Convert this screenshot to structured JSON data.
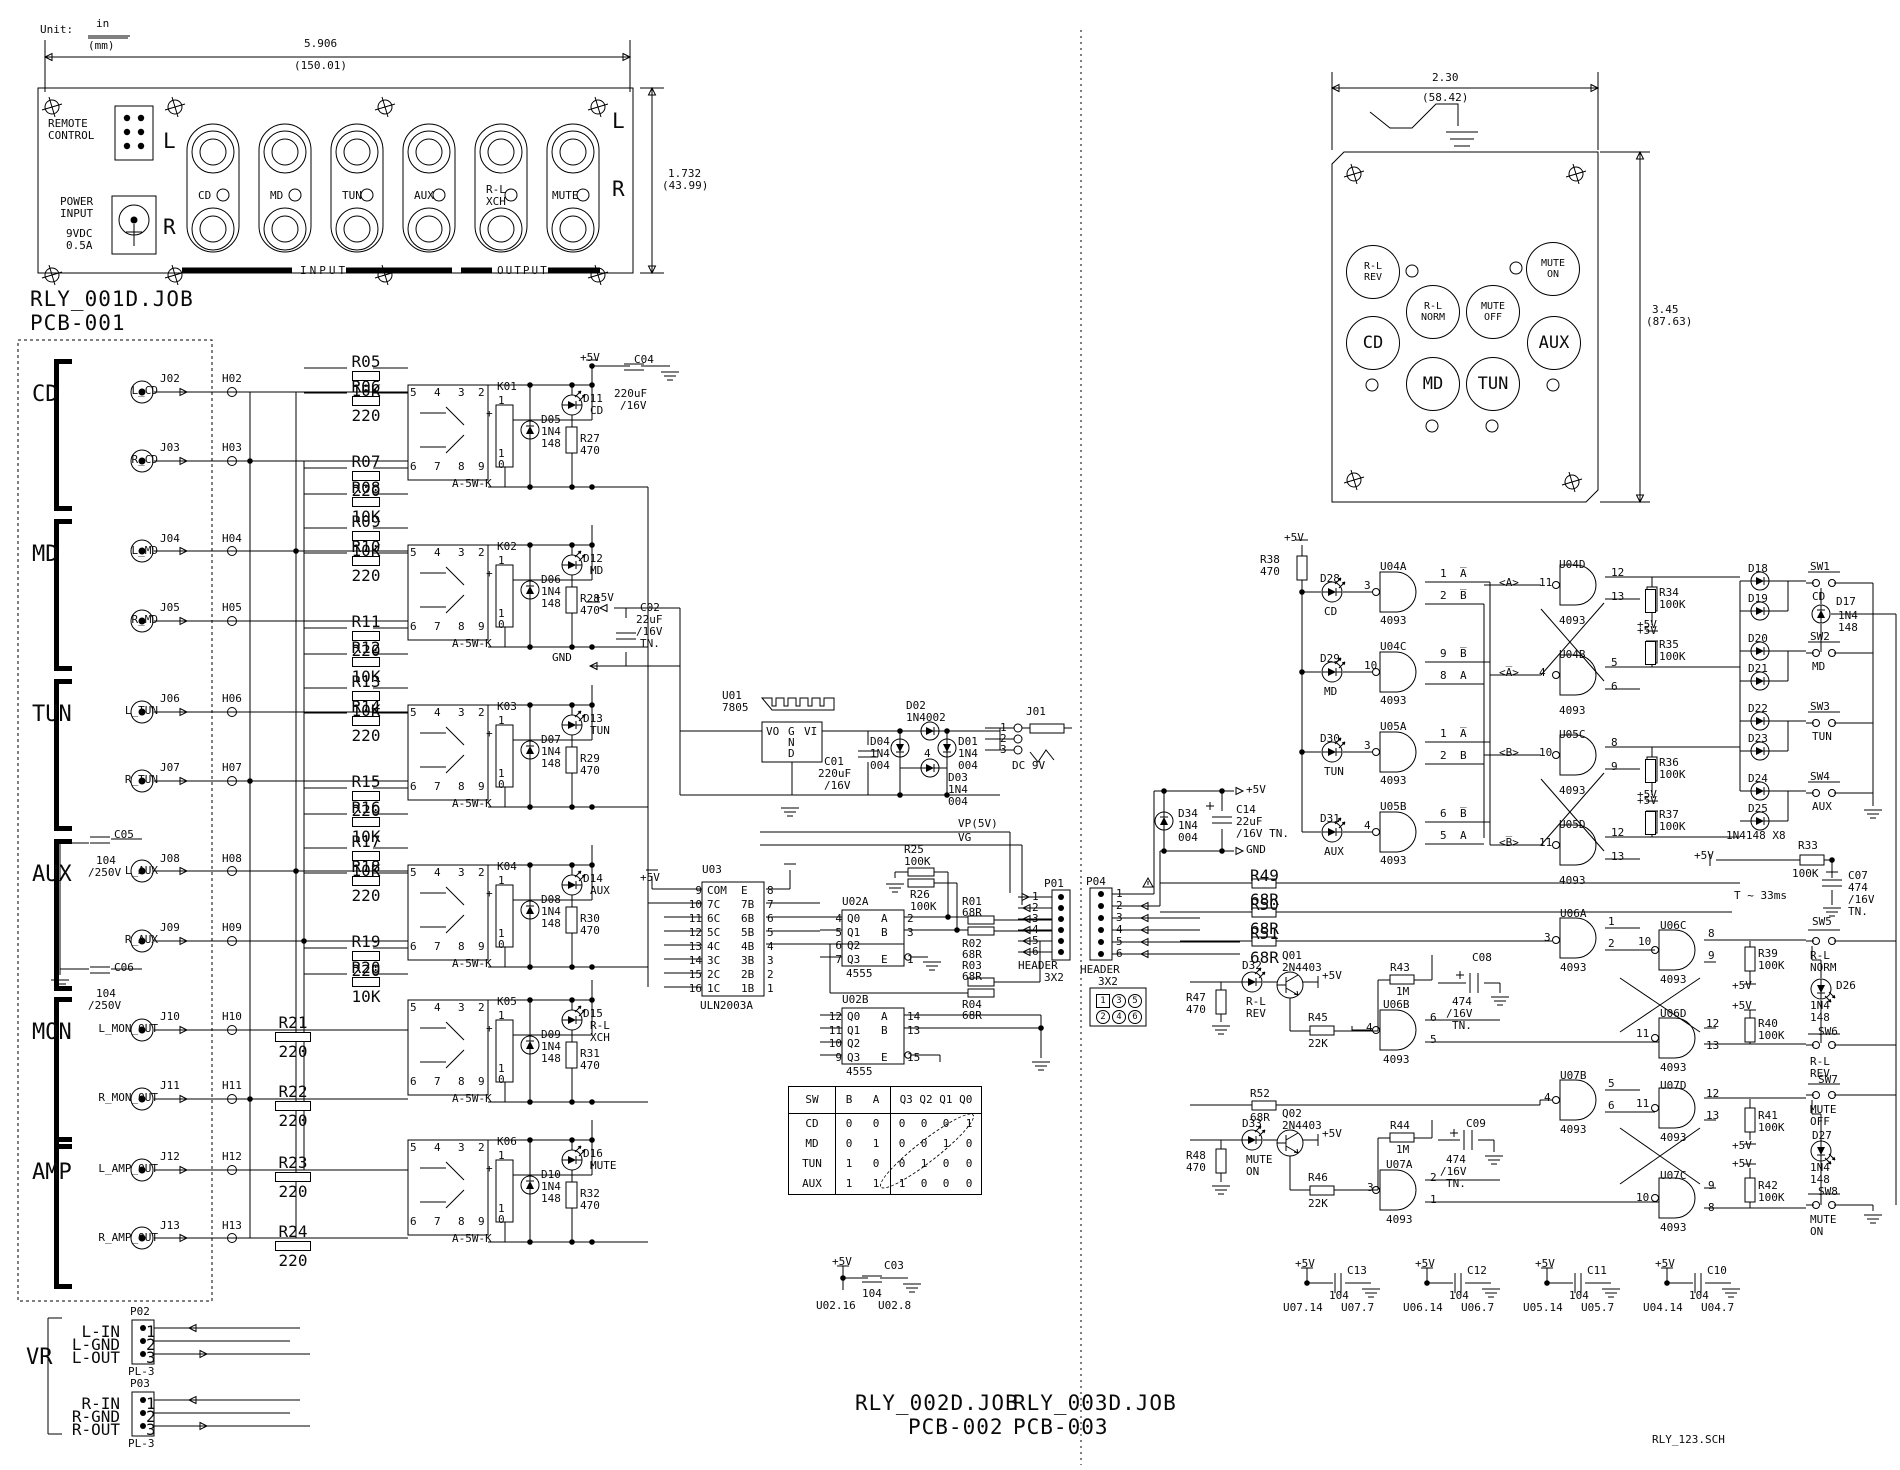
{
  "p5": "+5V",
  "gndl": "GND",
  "unit": {
    "label": "Unit:",
    "num": "in",
    "den": "(mm)"
  },
  "titles": {
    "pcb1_job": "RLY_001D.JOB",
    "pcb1": "PCB-001",
    "pcb2_job": "RLY_002D.JOB",
    "pcb2": "PCB-002",
    "pcb3_job": "RLY_003D.JOB",
    "pcb3": "PCB-003",
    "sch": "RLY_123.SCH"
  },
  "fp": {
    "dw": "5.906",
    "dwm": "(150.01)",
    "dh": "1.732",
    "dhm": "(43.99)",
    "rem1": "REMOTE",
    "rem2": "CONTROL",
    "pow1": "POWER",
    "pow2": "INPUT",
    "pow3": "9VDC",
    "pow4": "0.5A",
    "l": "L",
    "r": "R",
    "input": "INPUT",
    "output": "OUTPUT",
    "jacks": [
      {
        "l1": "CD",
        "l2": ""
      },
      {
        "l1": "MD",
        "l2": ""
      },
      {
        "l1": "TUN",
        "l2": ""
      },
      {
        "l1": "AUX",
        "l2": ""
      },
      {
        "l1": "R-L",
        "l2": "XCH"
      },
      {
        "l1": "MUTE",
        "l2": ""
      }
    ]
  },
  "remote": {
    "dw": "2.30",
    "dwm": "(58.42)",
    "dh": "3.45",
    "dhm": "(87.63)",
    "buttons": [
      {
        "l1": "R-L",
        "l2": "REV"
      },
      {
        "l1": "MUTE",
        "l2": "ON"
      },
      {
        "l1": "R-L",
        "l2": "NORM"
      },
      {
        "l1": "MUTE",
        "l2": "OFF"
      },
      {
        "l1": "CD",
        "l2": ""
      },
      {
        "l1": "AUX",
        "l2": ""
      },
      {
        "l1": "MD",
        "l2": ""
      },
      {
        "l1": "TUN",
        "l2": ""
      }
    ]
  },
  "pcb1": {
    "relay_part": "A-5W-K",
    "rp": {
      "a": "5",
      "b": "4",
      "c": "3",
      "d": "2",
      "e": "6",
      "f": "7",
      "g": "8",
      "h": "9",
      "i": "1",
      "j": "+",
      "k": "1",
      "l": "0"
    },
    "ch1": {
      "p5": "+5V",
      "c": "C04",
      "v1": "220uF",
      "v2": "/16V"
    },
    "groups": [
      {
        "label": "CD",
        "j1": {
          "name": "L_CD",
          "jack": "J02",
          "hdr": "H02",
          "r": "",
          "rv": ""
        },
        "j2": {
          "name": "R_CD",
          "jack": "J03",
          "hdr": "H03",
          "r": "",
          "rv": ""
        },
        "c1": {
          "n": "",
          "v1": "",
          "v2": ""
        },
        "c2": {
          "n": "",
          "v1": "",
          "v2": ""
        }
      },
      {
        "label": "MD",
        "j1": {
          "name": "L_MD",
          "jack": "J04",
          "hdr": "H04",
          "r": "",
          "rv": ""
        },
        "j2": {
          "name": "R_MD",
          "jack": "J05",
          "hdr": "H05",
          "r": "",
          "rv": ""
        },
        "c1": {
          "n": "",
          "v1": "",
          "v2": ""
        },
        "c2": {
          "n": "",
          "v1": "",
          "v2": ""
        }
      },
      {
        "label": "TUN",
        "j1": {
          "name": "L_TUN",
          "jack": "J06",
          "hdr": "H06",
          "r": "",
          "rv": ""
        },
        "j2": {
          "name": "R_TUN",
          "jack": "J07",
          "hdr": "H07",
          "r": "",
          "rv": ""
        },
        "c1": {
          "n": "",
          "v1": "",
          "v2": ""
        },
        "c2": {
          "n": "",
          "v1": "",
          "v2": ""
        }
      },
      {
        "label": "AUX",
        "j1": {
          "name": "L_AUX",
          "jack": "J08",
          "hdr": "H08",
          "r": "",
          "rv": ""
        },
        "j2": {
          "name": "R_AUX",
          "jack": "J09",
          "hdr": "H09",
          "r": "",
          "rv": ""
        },
        "c1": {
          "n": "C05",
          "v1": "104",
          "v2": "/250V"
        },
        "c2": {
          "n": "C06",
          "v1": "104",
          "v2": "/250V"
        }
      },
      {
        "label": "MON",
        "j1": {
          "name": "L_MON_OUT",
          "jack": "J10",
          "hdr": "H10",
          "r": "R21",
          "rv": "220"
        },
        "j2": {
          "name": "R_MON_OUT",
          "jack": "J11",
          "hdr": "H11",
          "r": "R22",
          "rv": "220"
        },
        "c1": {
          "n": "",
          "v1": "",
          "v2": ""
        },
        "c2": {
          "n": "",
          "v1": "",
          "v2": ""
        }
      },
      {
        "label": "AMP",
        "j1": {
          "name": "L_AMP_OUT",
          "jack": "J12",
          "hdr": "H12",
          "r": "R23",
          "rv": "220"
        },
        "j2": {
          "name": "R_AMP_OUT",
          "jack": "J13",
          "hdr": "H13",
          "r": "R24",
          "rv": "220"
        },
        "c1": {
          "n": "",
          "v1": "",
          "v2": ""
        },
        "c2": {
          "n": "",
          "v1": "",
          "v2": ""
        }
      }
    ],
    "channels": [
      {
        "k": "K01",
        "d": "D05",
        "dp1": "1N4",
        "dp2": "148",
        "led": "D11",
        "name": "CD",
        "name2": "",
        "r": "R27",
        "rv": "470",
        "ladder": [
          {
            "n": "R05",
            "v": "10K"
          },
          {
            "n": "R06",
            "v": "220"
          },
          {
            "n": "R07",
            "v": "220"
          },
          {
            "n": "R08",
            "v": "10K"
          }
        ]
      },
      {
        "k": "K02",
        "d": "D06",
        "dp1": "1N4",
        "dp2": "148",
        "led": "D12",
        "name": "MD",
        "name2": "",
        "r": "R28",
        "rv": "470",
        "ladder": [
          {
            "n": "R09",
            "v": "10K"
          },
          {
            "n": "R10",
            "v": "220"
          },
          {
            "n": "R11",
            "v": "220"
          },
          {
            "n": "R12",
            "v": "10K"
          }
        ]
      },
      {
        "k": "K03",
        "d": "D07",
        "dp1": "1N4",
        "dp2": "148",
        "led": "D13",
        "name": "TUN",
        "name2": "",
        "r": "R29",
        "rv": "470",
        "ladder": [
          {
            "n": "R13",
            "v": "10K"
          },
          {
            "n": "R14",
            "v": "220"
          },
          {
            "n": "R15",
            "v": "220"
          },
          {
            "n": "R16",
            "v": "10K"
          }
        ]
      },
      {
        "k": "K04",
        "d": "D08",
        "dp1": "1N4",
        "dp2": "148",
        "led": "D14",
        "name": "AUX",
        "name2": "",
        "r": "R30",
        "rv": "470",
        "ladder": [
          {
            "n": "R17",
            "v": "10K"
          },
          {
            "n": "R18",
            "v": "220"
          },
          {
            "n": "R19",
            "v": "220"
          },
          {
            "n": "R20",
            "v": "10K"
          }
        ]
      },
      {
        "k": "K05",
        "d": "D09",
        "dp1": "1N4",
        "dp2": "148",
        "led": "D15",
        "name": "R-L",
        "name2": "XCH",
        "r": "R31",
        "rv": "470",
        "ladder": []
      },
      {
        "k": "K06",
        "d": "D10",
        "dp1": "1N4",
        "dp2": "148",
        "led": "D16",
        "name": "MUTE",
        "name2": "",
        "r": "R32",
        "rv": "470",
        "ladder": []
      }
    ],
    "vr": {
      "label": "VR",
      "p02": {
        "n": "P02",
        "part": "PL-3",
        "pins": [
          {
            "pl": "L-IN",
            "pn": "1"
          },
          {
            "pl": "L-GND",
            "pn": "2"
          },
          {
            "pl": "L-OUT",
            "pn": "3"
          }
        ]
      },
      "p03": {
        "n": "P03",
        "part": "PL-3",
        "pins": [
          {
            "pl": "R-IN",
            "pn": "1"
          },
          {
            "pl": "R-GND",
            "pn": "2"
          },
          {
            "pl": "R-OUT",
            "pn": "3"
          }
        ]
      }
    }
  },
  "mid": {
    "pow": {
      "p5": "+5V",
      "gnd": "GND",
      "c02n": "C02",
      "c02v1": "22uF",
      "c02v2": "/16V",
      "c02v3": "TN.",
      "u": "U01",
      "upart": "7805",
      "vo": "VO",
      "g": "G",
      "n": "N",
      "d": "D",
      "vi": "VI",
      "c01n": "C01",
      "c01v1": "220uF",
      "c01v2": "/16V",
      "d02": "D02",
      "d02p": "1N4002",
      "d04": "D04",
      "d04p1": "1N4",
      "d04p2": "004",
      "d01": "D01",
      "d01p1": "1N4",
      "d01p2": "004",
      "d03": "D03",
      "d03p1": "1N4",
      "d03p2": "004",
      "bcount": "4",
      "j": "J01",
      "jp1": "1",
      "jp2": "2",
      "jp3": "3",
      "dc": "DC 9V",
      "vp": "VP(5V)",
      "vg": "VG"
    },
    "u03": {
      "n": "U03",
      "part": "ULN2003A",
      "p5": "+5V",
      "rows": [
        {
          "a": "9",
          "b": "COM",
          "c": "E",
          "d": "8"
        },
        {
          "a": "10",
          "b": "7C",
          "c": "7B",
          "d": "7"
        },
        {
          "a": "11",
          "b": "6C",
          "c": "6B",
          "d": "6"
        },
        {
          "a": "12",
          "b": "5C",
          "c": "5B",
          "d": "5"
        },
        {
          "a": "13",
          "b": "4C",
          "c": "4B",
          "d": "4"
        },
        {
          "a": "14",
          "b": "3C",
          "c": "3B",
          "d": "3"
        },
        {
          "a": "15",
          "b": "2C",
          "c": "2B",
          "d": "2"
        },
        {
          "a": "16",
          "b": "1C",
          "c": "1B",
          "d": "1"
        }
      ]
    },
    "u02a": {
      "n": "U02A",
      "part": "4555",
      "rows": [
        {
          "a": "4",
          "b": "Q0",
          "c": "A",
          "d": "2"
        },
        {
          "a": "5",
          "b": "Q1",
          "c": "B",
          "d": "3"
        },
        {
          "a": "6",
          "b": "Q2",
          "c": "",
          "d": ""
        },
        {
          "a": "7",
          "b": "Q3",
          "c": "E",
          "d": "1"
        }
      ]
    },
    "u02b": {
      "n": "U02B",
      "part": "4555",
      "rows": [
        {
          "a": "12",
          "b": "Q0",
          "c": "A",
          "d": "14"
        },
        {
          "a": "11",
          "b": "Q1",
          "c": "B",
          "d": "13"
        },
        {
          "a": "10",
          "b": "Q2",
          "c": "",
          "d": ""
        },
        {
          "a": "9",
          "b": "Q3",
          "c": "E",
          "d": "15"
        }
      ]
    },
    "r25": {
      "n": "R25",
      "v": "100K"
    },
    "r26": {
      "n": "R26",
      "v": "100K"
    },
    "rout": {
      "r1": "R01",
      "r1v": "68R",
      "r2": "R02",
      "r2v": "68R",
      "r3": "R03",
      "r3v": "68R",
      "r4": "R04",
      "r4v": "68R"
    },
    "p01": {
      "n": "P01",
      "part1": "HEADER",
      "part2": "3X2",
      "pins": [
        {
          "pn": "1"
        },
        {
          "pn": "2"
        },
        {
          "pn": "3"
        },
        {
          "pn": "4"
        },
        {
          "pn": "5"
        },
        {
          "pn": "6"
        }
      ]
    },
    "table": {
      "h": {
        "sw": "SW",
        "b": "B",
        "a": "A",
        "q": "Q3 Q2 Q1 Q0"
      },
      "rows": [
        {
          "sw": "CD",
          "b": "0",
          "a": "0",
          "q3": "0",
          "q2": "0",
          "q1": "0",
          "q0": "1"
        },
        {
          "sw": "MD",
          "b": "0",
          "a": "1",
          "q3": "0",
          "q2": "0",
          "q1": "1",
          "q0": "0"
        },
        {
          "sw": "TUN",
          "b": "1",
          "a": "0",
          "q3": "0",
          "q2": "1",
          "q1": "0",
          "q0": "0"
        },
        {
          "sw": "AUX",
          "b": "1",
          "a": "1",
          "q3": "1",
          "q2": "0",
          "q1": "0",
          "q0": "0"
        }
      ]
    },
    "c03": {
      "p5": "+5V",
      "n": "C03",
      "v": "104",
      "a": "U02.16",
      "b": "U02.8"
    }
  },
  "pcb3": {
    "p04": {
      "n": "P04",
      "part1": "HEADER",
      "part2": "3X2",
      "pins": [
        {
          "pn": "1"
        },
        {
          "pn": "2"
        },
        {
          "pn": "3"
        },
        {
          "pn": "4"
        },
        {
          "pn": "5"
        },
        {
          "pn": "6"
        }
      ],
      "legend": [
        {
          "c": "1"
        },
        {
          "c": "3"
        },
        {
          "c": "5"
        },
        {
          "c": "2"
        },
        {
          "c": "4"
        },
        {
          "c": "6"
        }
      ]
    },
    "d34": {
      "n": "D34",
      "p1": "1N4",
      "p2": "004"
    },
    "c14": {
      "n": "C14",
      "v1": "22uF",
      "v2": "/16V TN."
    },
    "r38": {
      "n": "R38",
      "v": "470"
    },
    "inputs": [
      {
        "led": "D28",
        "name": "CD",
        "pin": "3",
        "gate": "U04A",
        "part": "4093",
        "o1n": "1",
        "o1l": "A̅",
        "o2n": "2",
        "o2l": "B̅"
      },
      {
        "led": "D29",
        "name": "MD",
        "pin": "10",
        "gate": "U04C",
        "part": "4093",
        "o1n": "9",
        "o1l": "B̅",
        "o2n": "8",
        "o2l": "A"
      },
      {
        "led": "D30",
        "name": "TUN",
        "pin": "3",
        "gate": "U05A",
        "part": "4093",
        "o1n": "1",
        "o1l": "A̅",
        "o2n": "2",
        "o2l": "B"
      },
      {
        "led": "D31",
        "name": "AUX",
        "pin": "4",
        "gate": "U05B",
        "part": "4093",
        "o1n": "6",
        "o1l": "B̅",
        "o2n": "5",
        "o2l": "A"
      }
    ],
    "latches": [
      {
        "alab": "<A>",
        "pin": "11",
        "gate": "U04D",
        "part": "4093",
        "o1": "12",
        "o2": "13",
        "r": "R34",
        "rv": "100K"
      },
      {
        "alab": "<A̅>",
        "pin": "4",
        "gate": "U04B",
        "part": "4093",
        "o1": "5",
        "o2": "6",
        "r": "R35",
        "rv": "100K"
      },
      {
        "alab": "<B>",
        "pin": "10",
        "gate": "U05C",
        "part": "4093",
        "o1": "8",
        "o2": "9",
        "r": "R36",
        "rv": "100K"
      },
      {
        "alab": "<B̅>",
        "pin": "11",
        "gate": "U05D",
        "part": "4093",
        "o1": "12",
        "o2": "13",
        "r": "R37",
        "rv": "100K"
      }
    ],
    "matrix": [
      {
        "d1": "D18",
        "d2": "D19",
        "sw": "SW1",
        "name": "CD"
      },
      {
        "d1": "D20",
        "d2": "D21",
        "sw": "SW2",
        "name": "MD"
      },
      {
        "d1": "D22",
        "d2": "D23",
        "sw": "SW3",
        "name": "TUN"
      },
      {
        "d1": "D24",
        "d2": "D25",
        "sw": "SW4",
        "name": "AUX"
      }
    ],
    "d17": {
      "n": "D17",
      "p1": "1N4",
      "p2": "148"
    },
    "mnote": "1N4148 X8",
    "r33": {
      "n": "R33",
      "v": "100K"
    },
    "c07": {
      "n": "C07",
      "v1": "474",
      "v2": "/16V",
      "v3": "TN."
    },
    "tnote": "T ~ 33ms",
    "rheader": [
      {
        "n": "R49",
        "v": "68R"
      },
      {
        "n": "R50",
        "v": "68R"
      },
      {
        "n": "R51",
        "v": "68R"
      }
    ],
    "r52": {
      "n": "R52",
      "v": "68R"
    },
    "q01": {
      "n": "Q01",
      "part": "2N4403"
    },
    "d32": {
      "n": "D32",
      "l1": "R-L",
      "l2": "REV"
    },
    "r47": {
      "n": "R47",
      "v": "470"
    },
    "r45": {
      "n": "R45",
      "v": "22K"
    },
    "r43": {
      "n": "R43",
      "v": "1M"
    },
    "q02": {
      "n": "Q02",
      "part": "2N4403"
    },
    "d33": {
      "n": "D33",
      "l1": "MUTE",
      "l2": "ON"
    },
    "r48": {
      "n": "R48",
      "v": "470"
    },
    "r46": {
      "n": "R46",
      "v": "22K"
    },
    "r44": {
      "n": "R44",
      "v": "1M"
    },
    "u06a": {
      "g": "U06A",
      "p": "4093",
      "inn": "3",
      "o1": "1",
      "o2": "2"
    },
    "u06b": {
      "g": "U06B",
      "p": "4093",
      "inn": "4",
      "o1": "6",
      "o2": "5"
    },
    "u06c": {
      "g": "U06C",
      "p": "4093",
      "inn": "10",
      "o1": "8",
      "o2": "9"
    },
    "u06d": {
      "g": "U06D",
      "p": "4093",
      "inn": "11",
      "o1": "12",
      "o2": "13"
    },
    "u07a": {
      "g": "U07A",
      "p": "4093",
      "inn": "3",
      "o1": "2",
      "o2": "1"
    },
    "u07b": {
      "g": "U07B",
      "p": "4093",
      "inn": "4",
      "o1": "5",
      "o2": "6"
    },
    "u07c": {
      "g": "U07C",
      "p": "4093",
      "inn": "10",
      "o1": "9",
      "o2": "8"
    },
    "u07d": {
      "g": "U07D",
      "p": "4093",
      "inn": "11",
      "o1": "12",
      "o2": "13"
    },
    "r39": {
      "n": "R39",
      "v": "100K"
    },
    "r40": {
      "n": "R40",
      "v": "100K"
    },
    "r41": {
      "n": "R41",
      "v": "100K"
    },
    "r42": {
      "n": "R42",
      "v": "100K"
    },
    "sw5": {
      "n": "SW5",
      "l1": "R-L",
      "l2": "NORM"
    },
    "sw6": {
      "n": "SW6",
      "l1": "R-L",
      "l2": "REV"
    },
    "sw7": {
      "n": "SW7",
      "l1": "MUTE",
      "l2": "OFF"
    },
    "sw8": {
      "n": "SW8",
      "l1": "MUTE",
      "l2": "ON"
    },
    "d26": {
      "n": "D26",
      "p1": "1N4",
      "p2": "148"
    },
    "d27": {
      "n": "D27",
      "p1": "1N4",
      "p2": "148"
    },
    "c08": {
      "n": "C08",
      "v1": "474",
      "v2": "/16V",
      "v3": "TN."
    },
    "c09": {
      "n": "C09",
      "v1": "474",
      "v2": "/16V",
      "v3": "TN."
    },
    "bypass": [
      {
        "n": "C13",
        "v": "104",
        "a": "U07.14",
        "b": "U07.7"
      },
      {
        "n": "C12",
        "v": "104",
        "a": "U06.14",
        "b": "U06.7"
      },
      {
        "n": "C11",
        "v": "104",
        "a": "U05.14",
        "b": "U05.7"
      },
      {
        "n": "C10",
        "v": "104",
        "a": "U04.14",
        "b": "U04.7"
      }
    ]
  }
}
